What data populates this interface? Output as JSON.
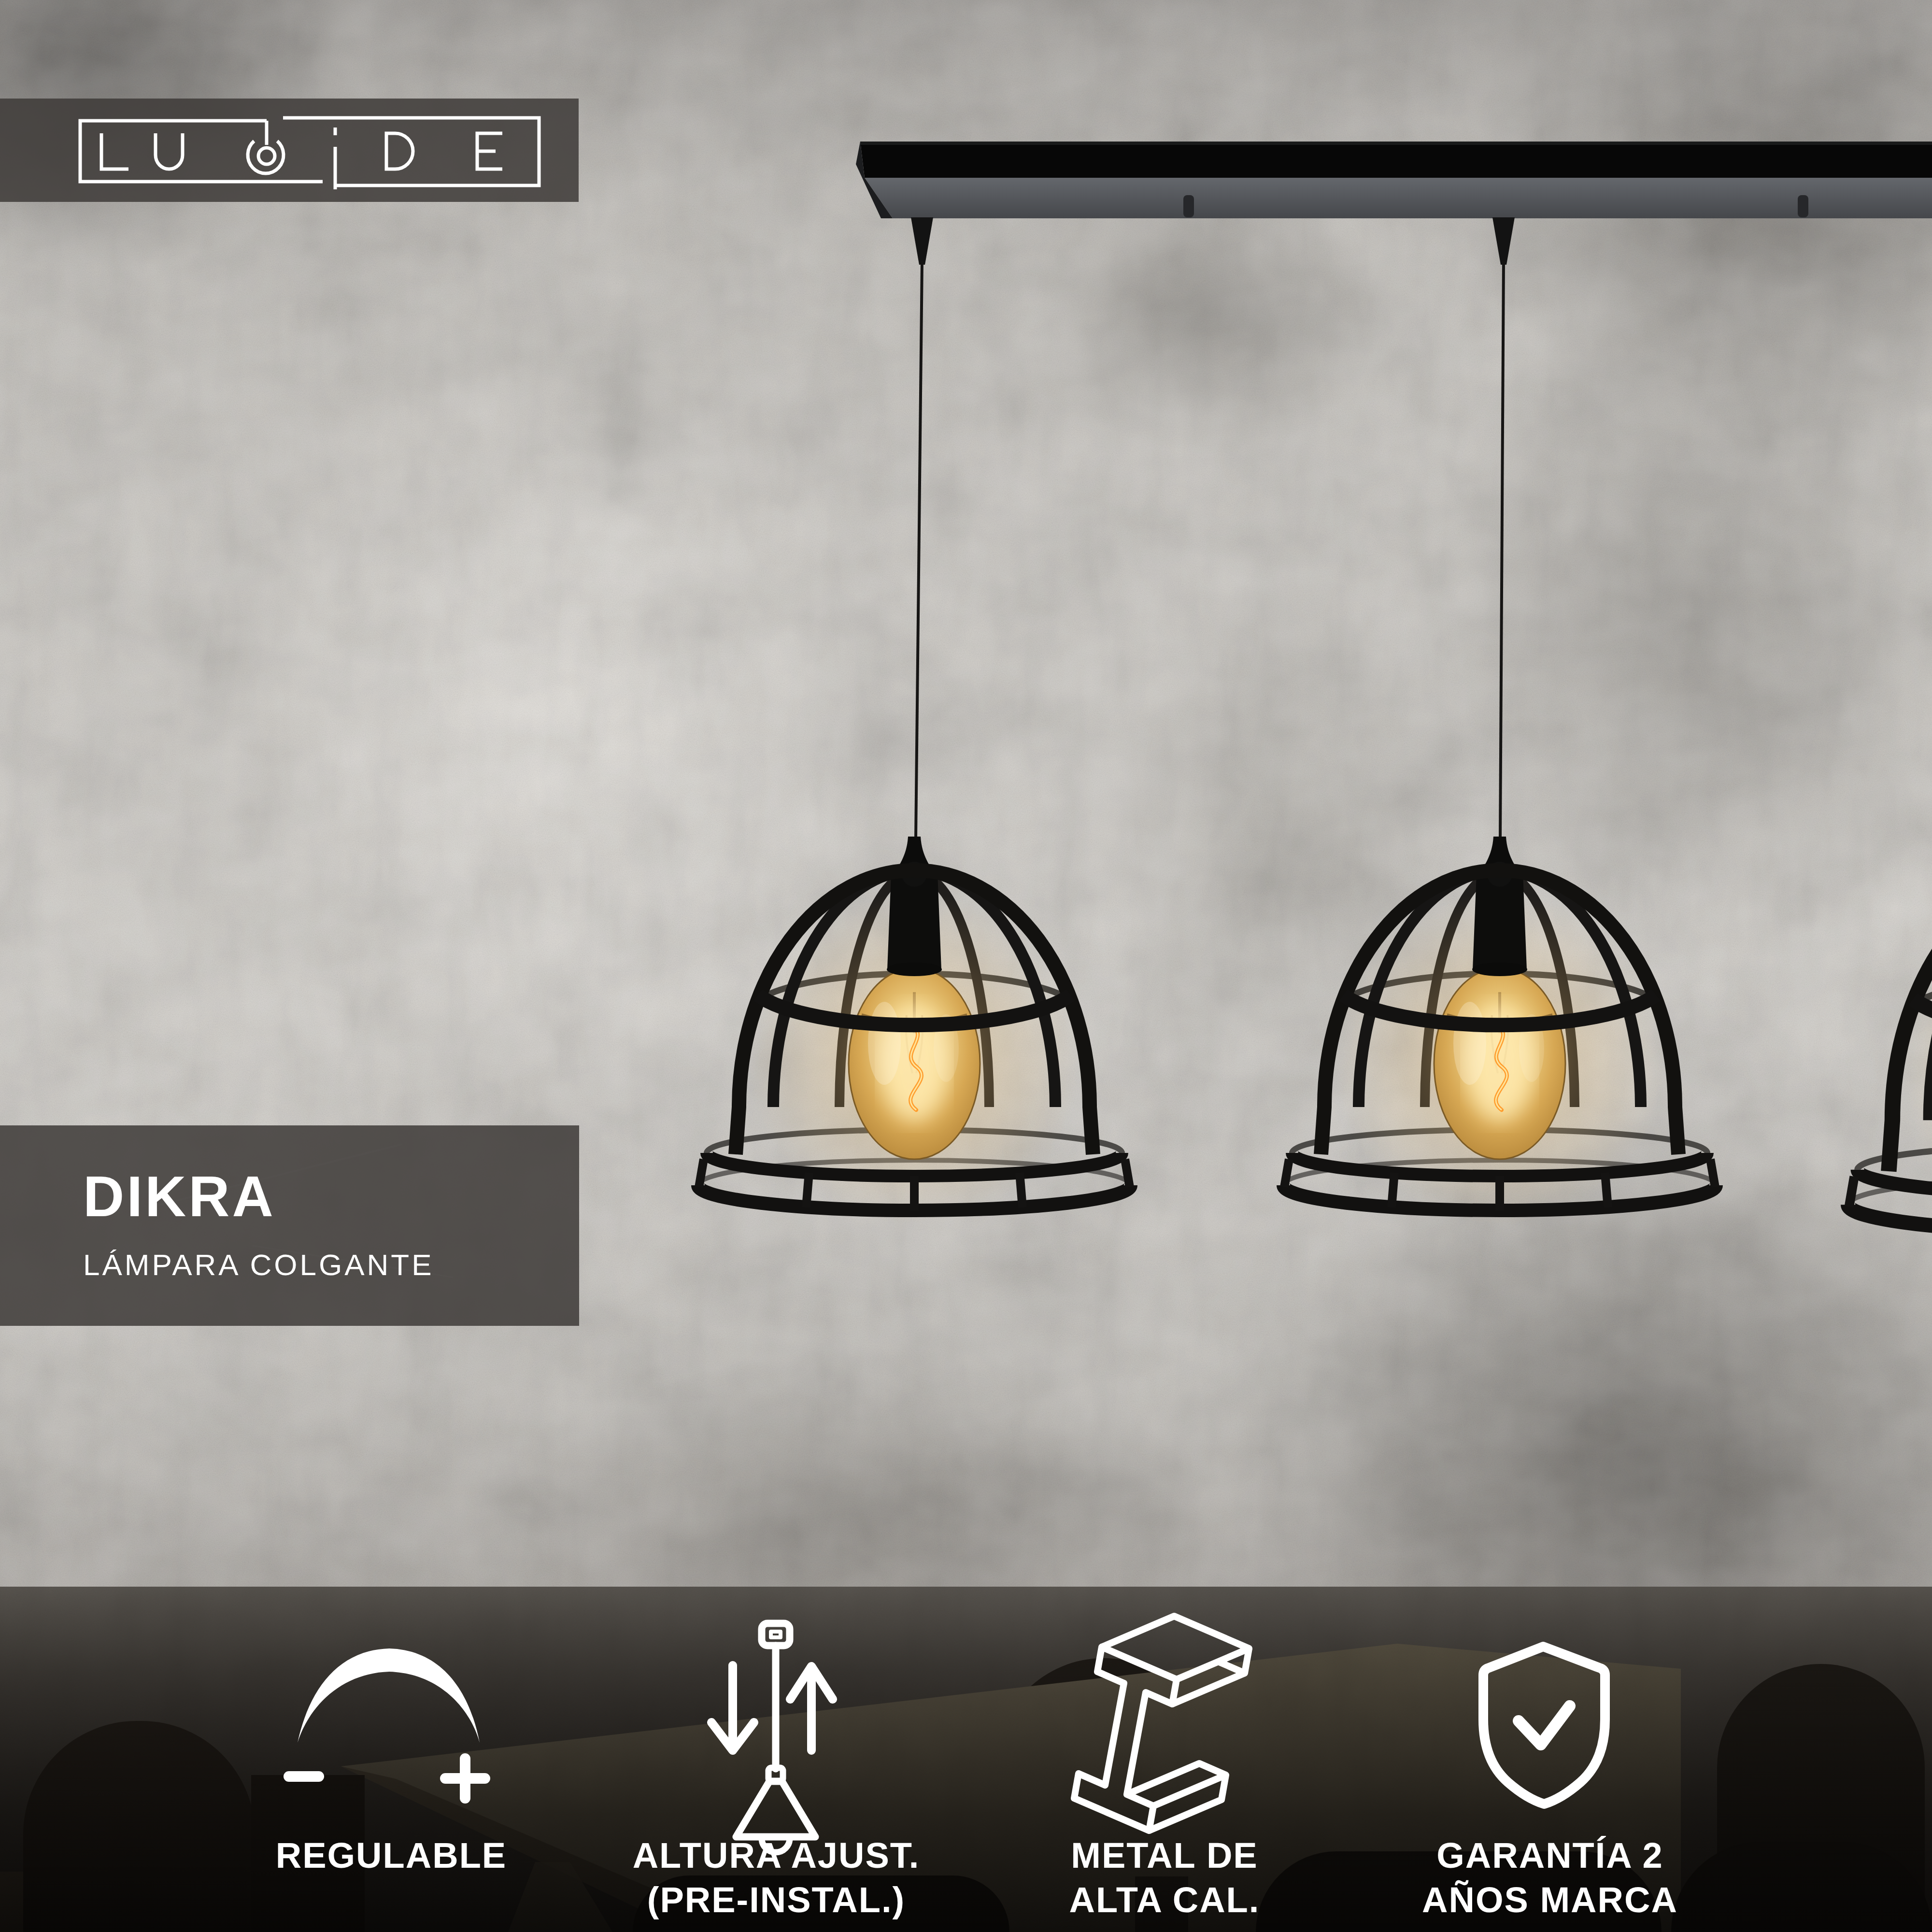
{
  "brand": {
    "name": "LUCIDE"
  },
  "product": {
    "name": "DIKRA",
    "subtitle": "L\u00c1MPARA COLGANTE"
  },
  "features": {
    "items": [
      {
        "icon": "dimmer-icon",
        "line1": "REGULABLE",
        "line2": ""
      },
      {
        "icon": "adjustable-height-icon",
        "line1": "ALTURA AJUST.",
        "line2": "(PRE-INSTAL.)"
      },
      {
        "icon": "metal-beam-icon",
        "line1": "METAL DE",
        "line2": "ALTA CAL."
      },
      {
        "icon": "warranty-shield-icon",
        "line1": "GARANT\u00cdA 2",
        "line2": "A\u00d1OS MARCA"
      }
    ]
  },
  "scene": {
    "pendant_count": 3,
    "bulb_style": "amber filament globe"
  },
  "colors": {
    "overlay_box": "rgba(61,58,55,0.85)",
    "text": "#ffffff",
    "lamp_black": "#121110",
    "bulb_amber": "#d9a855",
    "wall_light": "#d7d4cf",
    "bottom_overlay": "#0d0b09"
  }
}
